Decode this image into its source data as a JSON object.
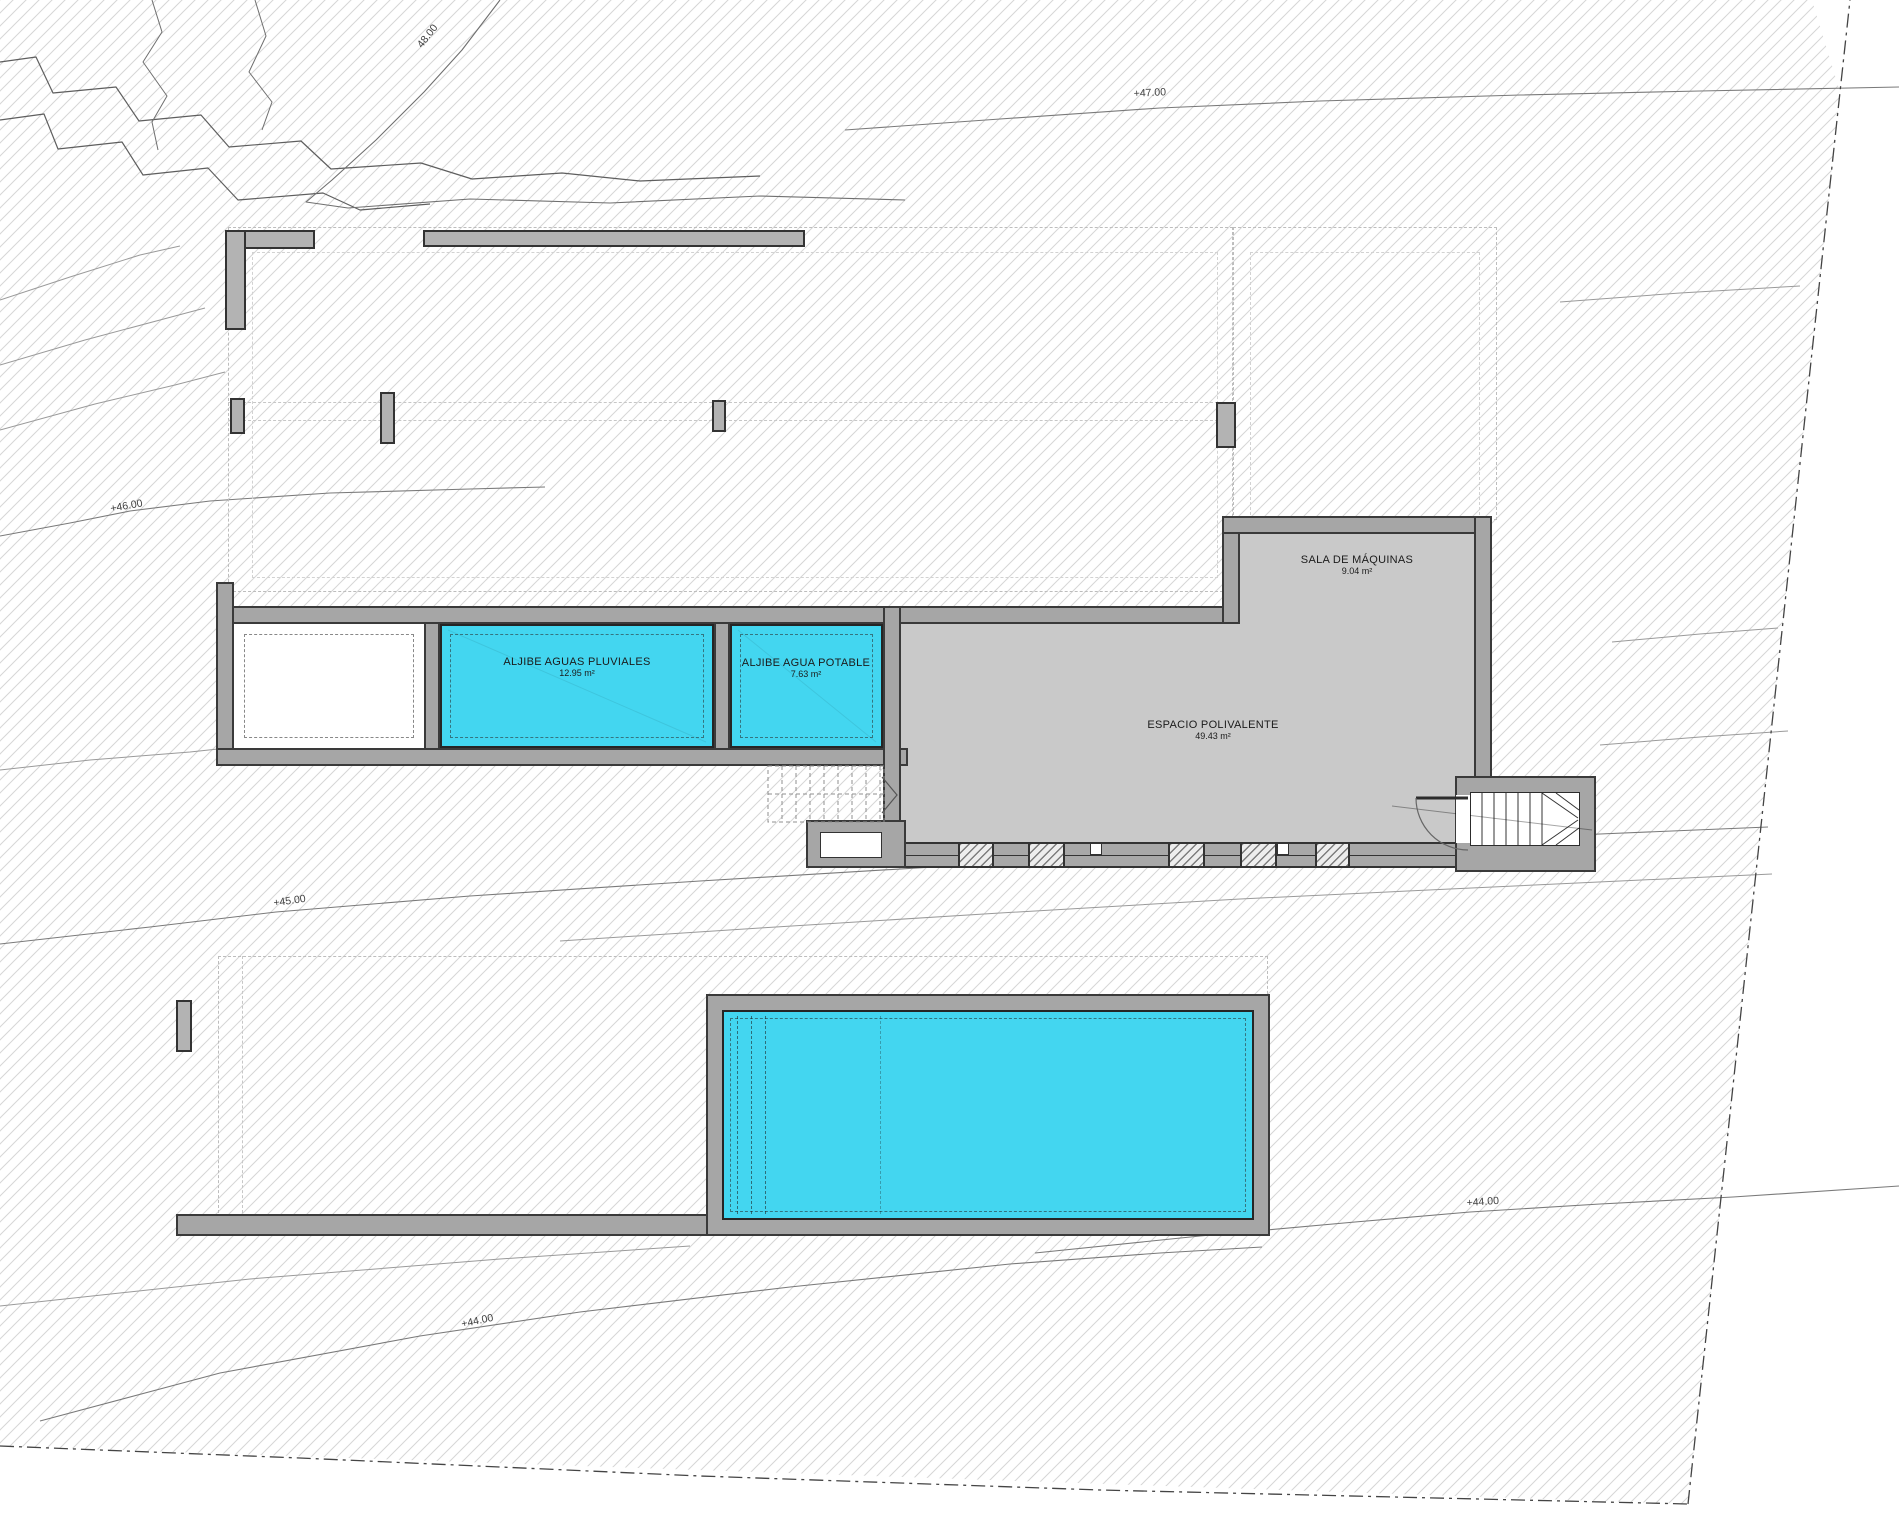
{
  "rooms": {
    "sala": {
      "name": "SALA DE MÁQUINAS",
      "area": "9.04 m²"
    },
    "pluviales": {
      "name": "ALJIBE AGUAS PLUVIALES",
      "area": "12.95 m²"
    },
    "potable": {
      "name": "ALJIBE AGUA POTABLE",
      "area": "7.63 m²"
    },
    "polivalente": {
      "name": "ESPACIO POLIVALENTE",
      "area": "49.43 m²"
    }
  },
  "contours": {
    "c48": "48.00",
    "c47": "+47.00",
    "c46": "+46.00",
    "c45": "+45.00",
    "c44_right": "+44.00",
    "c44_bottom": "+44.00"
  },
  "colors": {
    "water": "#43d6f0",
    "wall_fill": "#a6a6a6",
    "wall_outline": "#3a3a3a",
    "room_fill": "#c9c9c9",
    "hatch_line": "#d6d6d6",
    "contour_line": "#9a9a9a",
    "boundary_line": "#444444"
  }
}
